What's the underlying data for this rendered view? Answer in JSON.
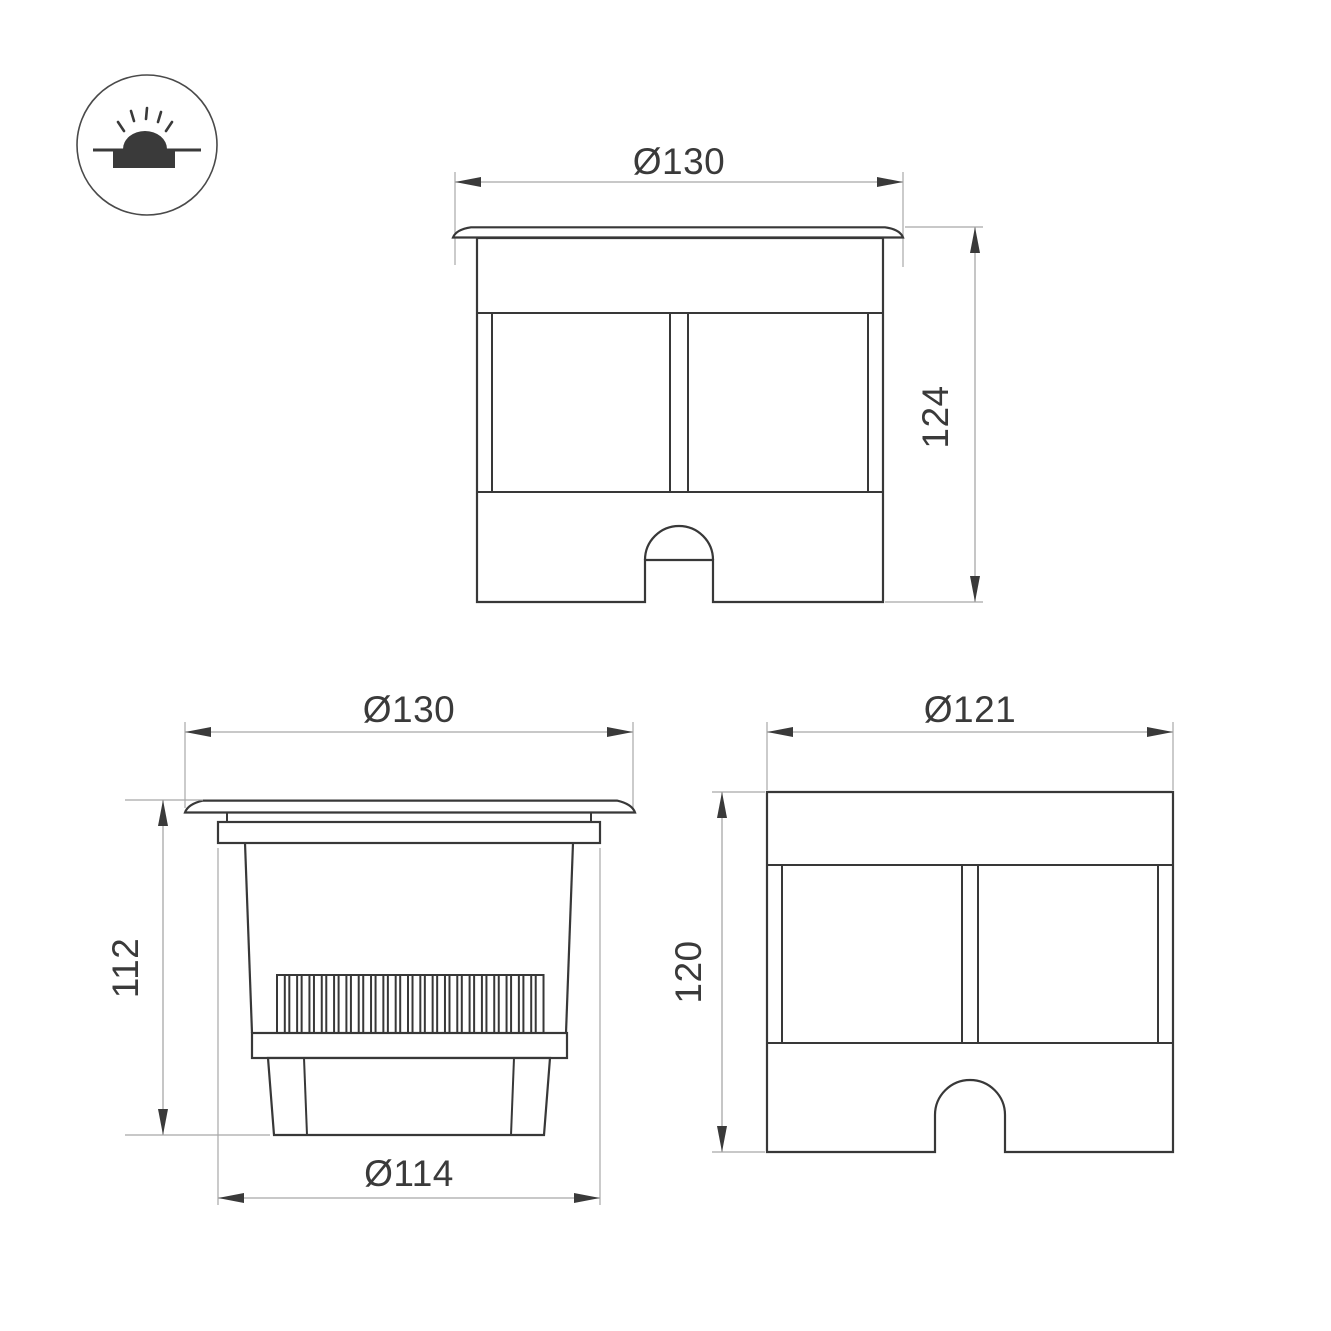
{
  "colors": {
    "line": "#383838",
    "dim_line": "#a8a8a8",
    "text": "#3a3a3a",
    "background": "#ffffff"
  },
  "figure": {
    "fin_count": 22
  },
  "views": {
    "front": {
      "width_dim": "Ø130",
      "height_dim": "124"
    },
    "section": {
      "width_dim": "Ø130",
      "height_dim": "112",
      "base_dim": "Ø114"
    },
    "rear": {
      "width_dim": "Ø121",
      "height_dim": "120"
    }
  }
}
